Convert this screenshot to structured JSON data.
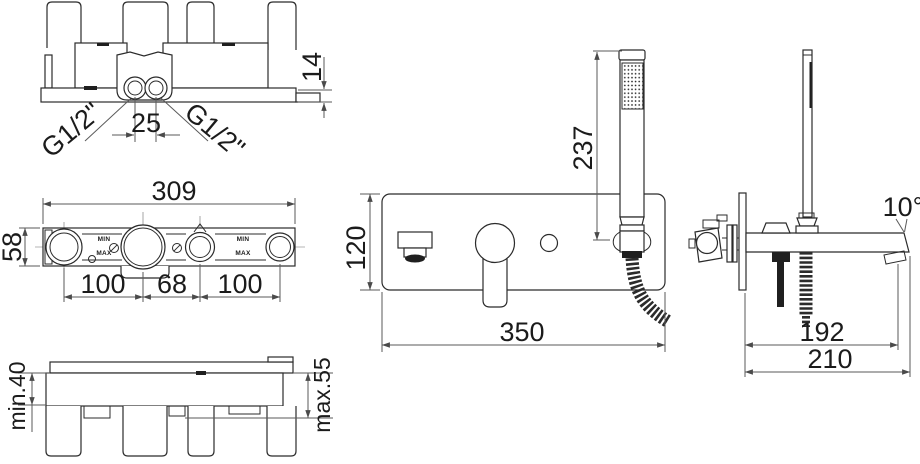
{
  "drawing": {
    "background": "#ffffff",
    "line_color": "#2b2b2b",
    "dim_line_color": "#5a5a5a",
    "views": {
      "body_top": {
        "dims": {
          "plate_thickness": "14",
          "port_spacing": "25",
          "port_left": "G1/2\"",
          "port_right": "G1/2\""
        }
      },
      "body_front": {
        "dims": {
          "overall_width": "309",
          "body_height": "58",
          "span_left": "100",
          "span_center": "68",
          "span_right": "100"
        },
        "marks": {
          "min_left": "MIN",
          "max_left": "MAX",
          "min_right": "MIN",
          "max_right": "MAX"
        }
      },
      "body_depth": {
        "dims": {
          "depth_min": "min.40",
          "depth_max": "max.55"
        }
      },
      "mixer_front": {
        "dims": {
          "plate_height": "120",
          "handshower_height": "237",
          "plate_width": "350"
        }
      },
      "mixer_side": {
        "dims": {
          "spout_angle": "10°",
          "reach_aerator": "192",
          "reach_total": "210"
        }
      }
    }
  }
}
